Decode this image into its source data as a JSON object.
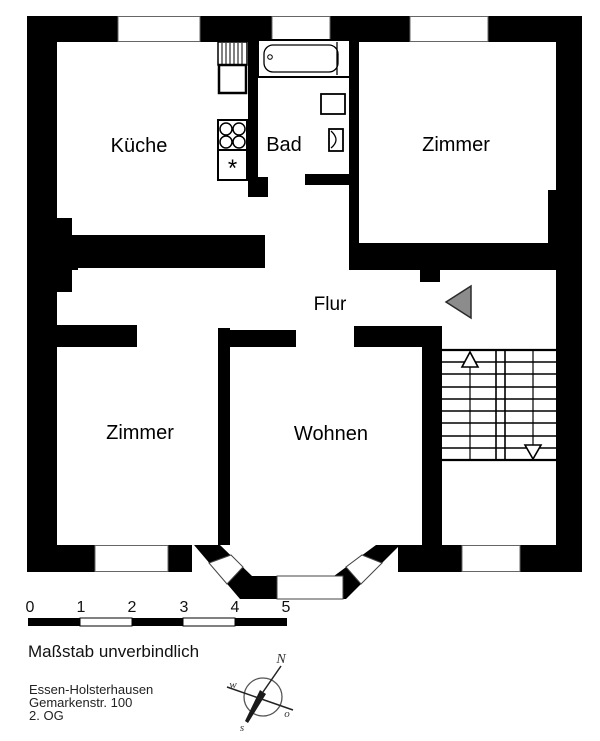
{
  "rooms": {
    "kueche": "Küche",
    "bad": "Bad",
    "zimmer_top": "Zimmer",
    "flur": "Flur",
    "zimmer_bottom": "Zimmer",
    "wohnen": "Wohnen"
  },
  "fixtures": {
    "fridge_symbol": "*"
  },
  "scale_bar": {
    "ticks": [
      "0",
      "1",
      "2",
      "3",
      "4",
      "5"
    ],
    "note": "Maßstab unverbindlich"
  },
  "address": {
    "line1": "Essen-Holsterhausen",
    "line2": "Gemarkenstr. 100",
    "line3": "2. OG"
  },
  "compass": {
    "north": "N",
    "west": "w",
    "east": "o",
    "south": "s"
  },
  "colors": {
    "wall": "#000000",
    "background": "#ffffff",
    "entrance_arrow": "#8c8c8c",
    "window_edge": "#666666"
  }
}
